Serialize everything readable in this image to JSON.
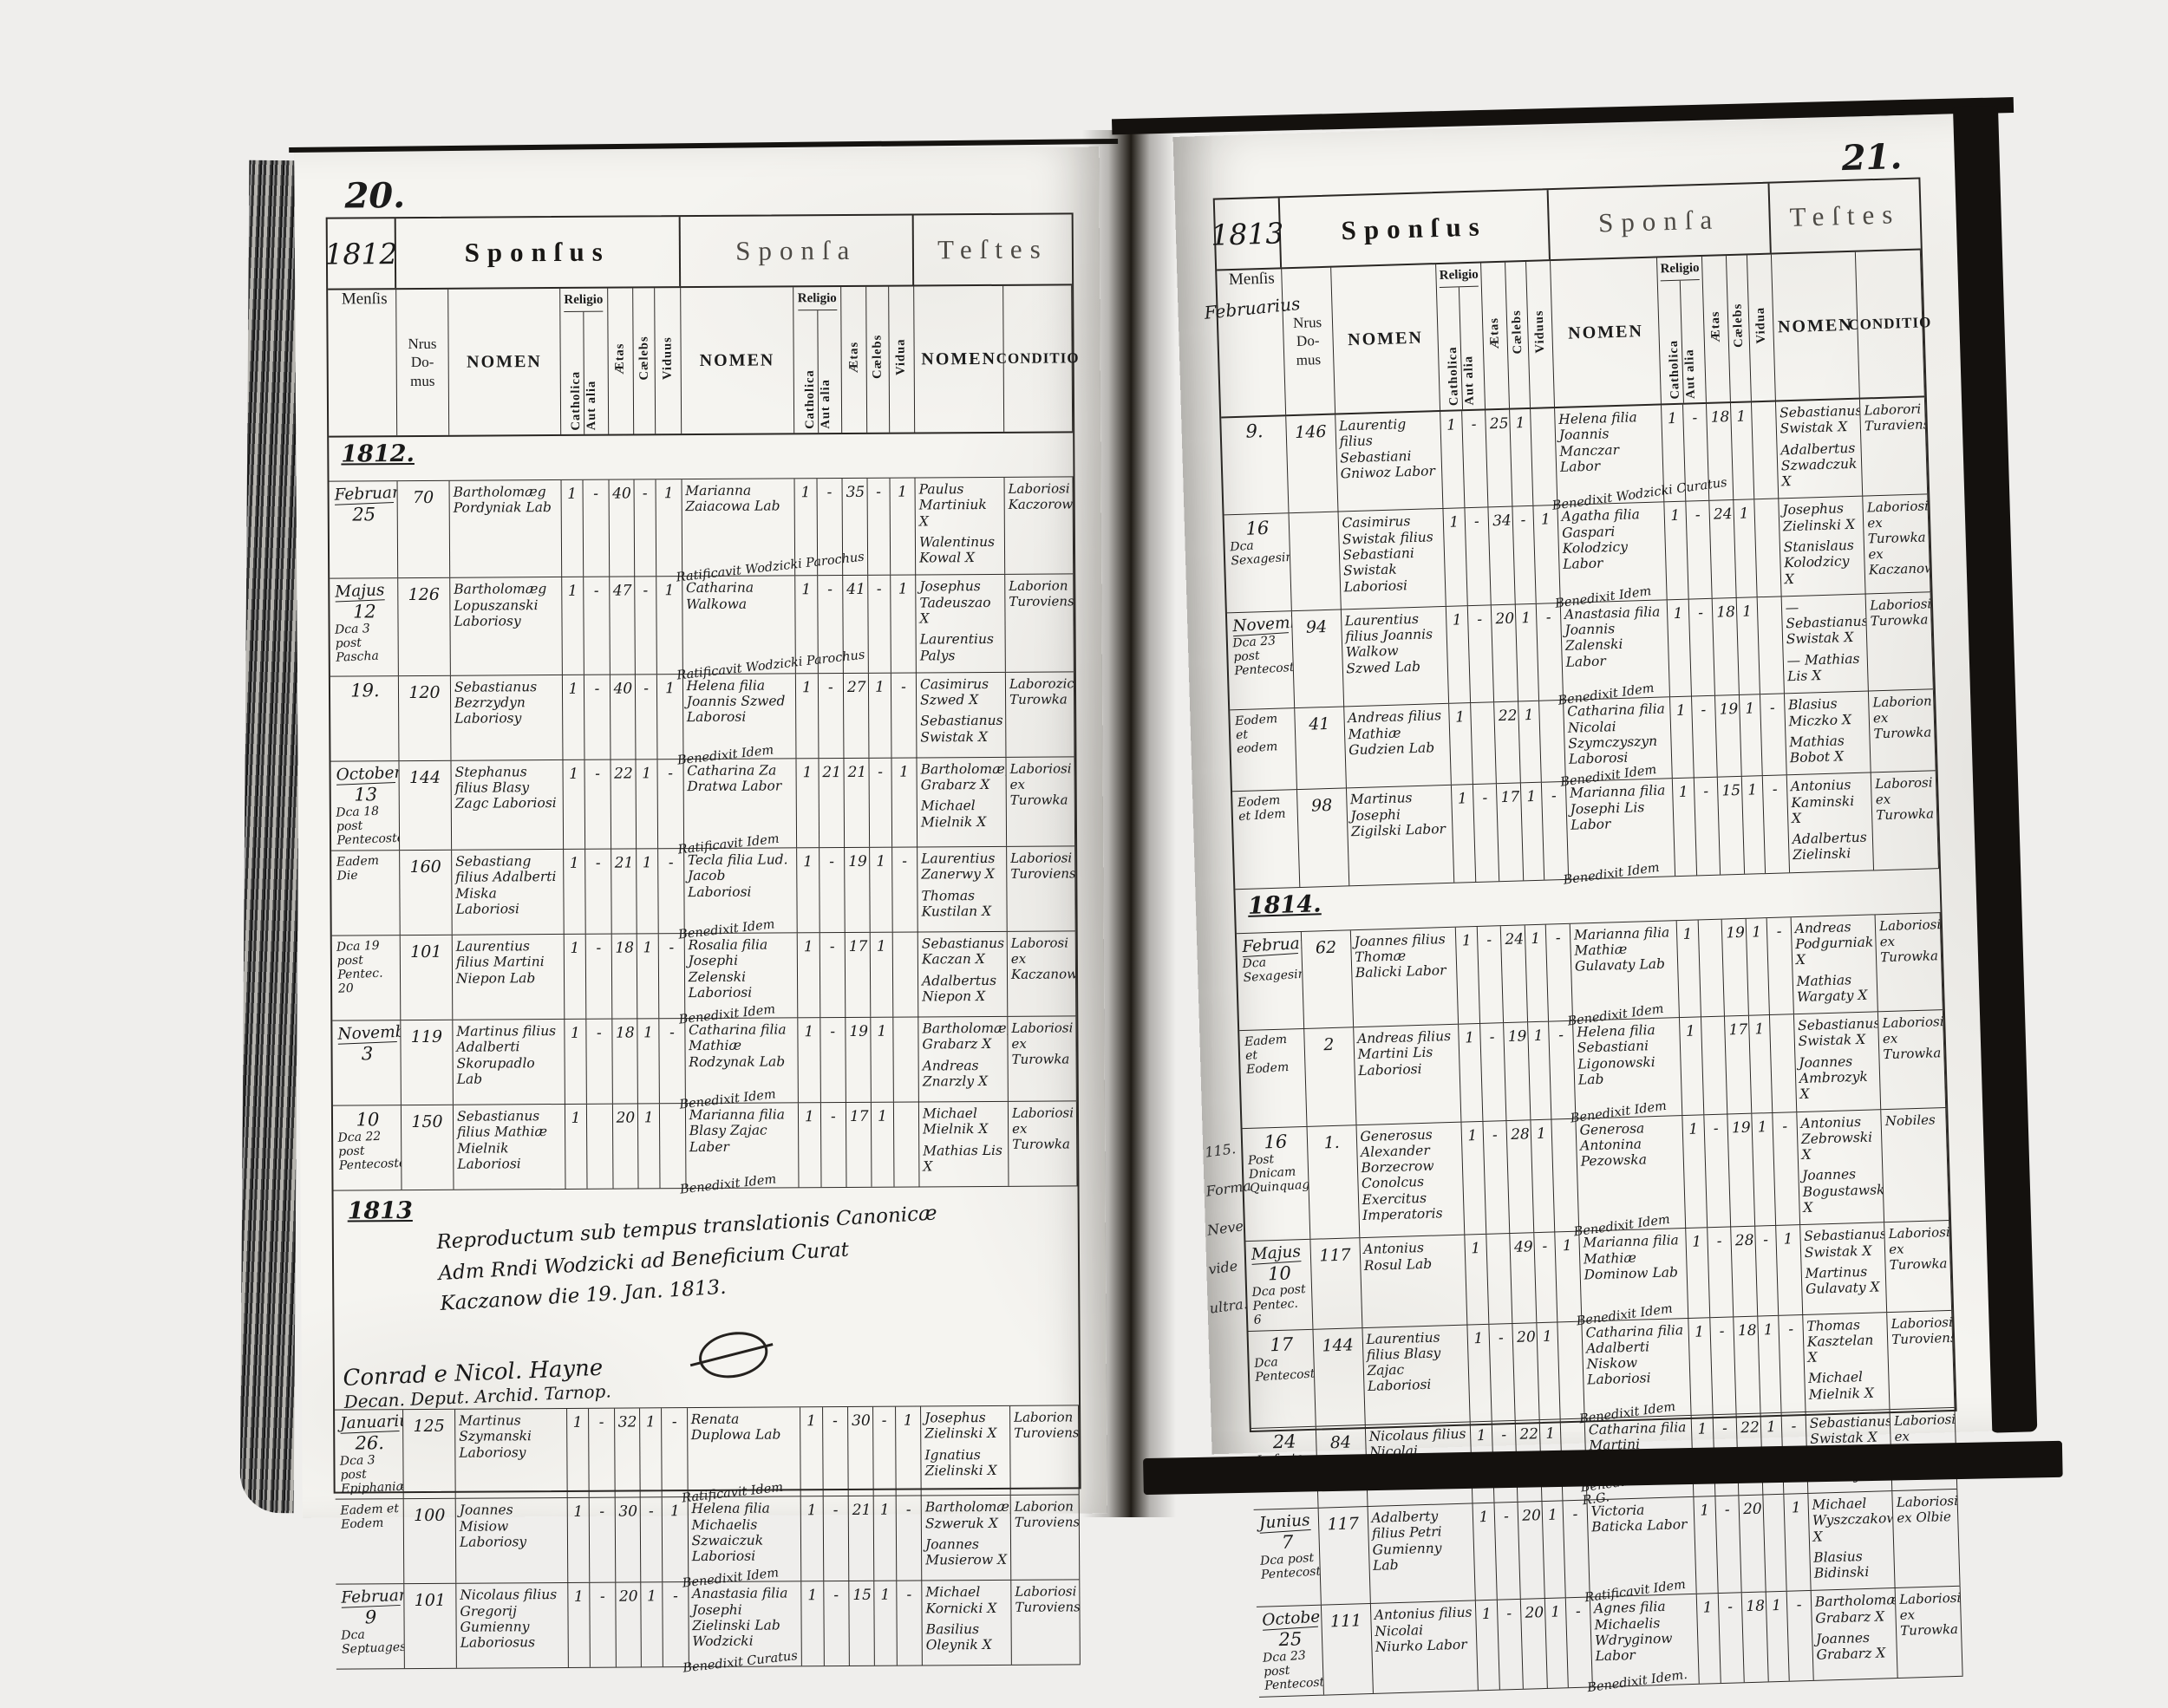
{
  "document": {
    "kind": "scanned parish marriage register, two-page spread"
  },
  "book": {
    "header_labels": {
      "sponsus": "Sponſus",
      "sponsa": "Sponſa",
      "testes": "Teſtes",
      "mensis": "Menſis",
      "nrus": "Nrus\nDo-\nmus",
      "nomen": "NOMEN",
      "religio": "Religio",
      "catholica": "Catholica",
      "aut_alia": "Aut alia",
      "aetas": "Ætas",
      "caelebs": "Cælebs",
      "viduus": "Viduus",
      "vidua": "Vidua",
      "conditio": "CONDITIO"
    },
    "left_page": {
      "page_number": "20.",
      "year_box": "1812",
      "rows": [
        {
          "type": "year",
          "label": "1812."
        },
        {
          "type": "entry",
          "month": "Februarius",
          "day": "25",
          "extra": "",
          "nrus": "70",
          "sponsus": "Bartholomæg Pordyniak Lab",
          "s": [
            "1",
            "-",
            "40",
            "-",
            "1"
          ],
          "sponsa": "Marianna Zaiacowa Lab",
          "ben": "Ratificavit Wodzicki Parochus",
          "sp": [
            "1",
            "-",
            "35",
            "-",
            "1"
          ],
          "testes": [
            "Paulus Martiniuk X",
            "Walentinus Kowal X"
          ],
          "conditio": "Laboriosi Kaczorowca"
        },
        {
          "type": "entry",
          "month": "Majus",
          "day": "12",
          "extra": "Dca 3 post Pascha",
          "nrus": "126",
          "sponsus": "Bartholomæg Lopuszanski Laboriosy",
          "s": [
            "1",
            "-",
            "47",
            "-",
            "1"
          ],
          "sponsa": "Catharina Walkowa",
          "ben": "Ratificavit Wodzicki Parochus",
          "sp": [
            "1",
            "-",
            "41",
            "-",
            "1"
          ],
          "testes": [
            "Josephus Tadeuszao X",
            "Laurentius Palys"
          ],
          "conditio": "Laborion Turoviensis"
        },
        {
          "type": "entry",
          "month": "",
          "day": "19.",
          "extra": "",
          "nrus": "120",
          "sponsus": "Sebastianus Bezrzydyn Laboriosy",
          "s": [
            "1",
            "-",
            "40",
            "-",
            "1"
          ],
          "sponsa": "Helena filia Joannis Szwed Laborosi",
          "ben": "Benedixit Idem",
          "sp": [
            "1",
            "-",
            "27",
            "1",
            "-"
          ],
          "testes": [
            "Casimirus Szwed X",
            "Sebastianus Swistak X"
          ],
          "conditio": "Laborozica Turowka"
        },
        {
          "type": "entry",
          "month": "October",
          "day": "13",
          "extra": "Dca 18 post Pentecosten",
          "nrus": "144",
          "sponsus": "Stephanus filius Blasy Zagc Laboriosi",
          "s": [
            "1",
            "-",
            "22",
            "1",
            "-"
          ],
          "sponsa": "Catharina Za Dratwa Labor",
          "ben": "Ratificavit Idem",
          "sp": [
            "1",
            "21",
            "21",
            "-",
            "1"
          ],
          "testes": [
            "Bartholomæg Grabarz X",
            "Michael Mielnik X"
          ],
          "conditio": "Laboriosi ex Turowka"
        },
        {
          "type": "entry",
          "month": "",
          "day": "",
          "extra": "Eadem Die",
          "nrus": "160",
          "sponsus": "Sebastiang filius Adalberti Miska Laboriosi",
          "s": [
            "1",
            "-",
            "21",
            "1",
            "-"
          ],
          "sponsa": "Tecla filia Lud. Jacob Laboriosi",
          "ben": "Benedixit Idem",
          "sp": [
            "1",
            "-",
            "19",
            "1",
            "-"
          ],
          "testes": [
            "Laurentius Zanerwy X",
            "Thomas Kustilan X"
          ],
          "conditio": "Laboriosi Turoviensis"
        },
        {
          "type": "entry",
          "month": "",
          "day": "",
          "extra": "Dca 19 post Pentec. 20",
          "nrus": "101",
          "sponsus": "Laurentius filius Martini Niepon Lab",
          "s": [
            "1",
            "-",
            "18",
            "1",
            "-"
          ],
          "sponsa": "Rosalia filia Josephi Zelenski Laboriosi",
          "ben": "Benedixit Idem",
          "sp": [
            "1",
            "-",
            "17",
            "1",
            ""
          ],
          "testes": [
            "Sebastianus Kaczan X",
            "Adalbertus Niepon X"
          ],
          "conditio": "Laborosi ex Kaczanowka"
        },
        {
          "type": "entry",
          "month": "November",
          "day": "3",
          "extra": "",
          "nrus": "119",
          "sponsus": "Martinus filius Adalberti Skorupadlo Lab",
          "s": [
            "1",
            "-",
            "18",
            "1",
            "-"
          ],
          "sponsa": "Catharina filia Mathiæ Rodzynak Lab",
          "ben": "Benedixit Idem",
          "sp": [
            "1",
            "-",
            "19",
            "1",
            ""
          ],
          "testes": [
            "Bartholomæg Grabarz X",
            "Andreas Znarzly X"
          ],
          "conditio": "Laboriosi ex Turowka"
        },
        {
          "type": "entry",
          "month": "",
          "day": "10",
          "extra": "Dca 22 post Pentecosten",
          "nrus": "150",
          "sponsus": "Sebastianus filius Mathiæ Mielnik Laboriosi",
          "s": [
            "1",
            "",
            "20",
            "1",
            ""
          ],
          "sponsa": "Marianna filia Blasy Zajac Laber",
          "ben": "Benedixit Idem",
          "sp": [
            "1",
            "-",
            "17",
            "1",
            ""
          ],
          "testes": [
            "Michael Mielnik X",
            "Mathias Lis X"
          ],
          "conditio": "Laboriosi ex Turowka"
        },
        {
          "type": "note",
          "year": "1813",
          "lines": [
            "Reproductum sub tempus translationis Canonicæ",
            "Adm Rndi Wodzicki ad Beneficium Curat",
            "Kaczanow        die 19. Jan. 1813."
          ],
          "signature": [
            "Conrad e Nicol. Hayne",
            "Decan. Deput. Archid. Tarnop."
          ]
        },
        {
          "type": "entry",
          "month": "Januarius",
          "day": "26.",
          "extra": "Dca 3 post Epiphaniæ",
          "nrus": "125",
          "sponsus": "Martinus Szymanski Laboriosy",
          "s": [
            "1",
            "-",
            "32",
            "1",
            "-"
          ],
          "sponsa": "Renata Duplowa Lab",
          "ben": "Ratificavit Idem",
          "sp": [
            "1",
            "-",
            "30",
            "-",
            "1"
          ],
          "testes": [
            "Josephus Zielinski X",
            "Ignatius Zielinski X"
          ],
          "conditio": "Laborion Turoviensis"
        },
        {
          "type": "entry",
          "month": "",
          "day": "",
          "extra": "Eadem et Eodem",
          "nrus": "100",
          "sponsus": "Joannes Misiow Laboriosy",
          "s": [
            "1",
            "-",
            "30",
            "-",
            "1"
          ],
          "sponsa": "Helena filia Michaelis Szwaiczuk Laboriosi",
          "ben": "Benedixit Idem",
          "sp": [
            "1",
            "-",
            "21",
            "1",
            "-"
          ],
          "testes": [
            "Bartholomæg Szweruk X",
            "Joannes Musierow X"
          ],
          "conditio": "Laborion Turoviensis"
        },
        {
          "type": "entry",
          "month": "Februarius",
          "day": "9",
          "extra": "Dca Septuagesima",
          "nrus": "101",
          "sponsus": "Nicolaus filius Gregorij Gumienny Laboriosus",
          "s": [
            "1",
            "-",
            "20",
            "1",
            "-"
          ],
          "sponsa": "Anastasia filia Josephi Zielinski Lab Wodzicki",
          "ben": "Benedixit Curatus",
          "sp": [
            "1",
            "-",
            "15",
            "1",
            "-"
          ],
          "testes": [
            "Michael Kornicki X",
            "Basilius Oleynik X"
          ],
          "conditio": "Laboriosi Turoviensis"
        }
      ]
    },
    "right_page": {
      "page_number": "21.",
      "year_box": "1813",
      "mensis_hw": "Februarius",
      "margin_notes": [
        "115.",
        "Forma",
        "Neve",
        "vide",
        "ultra."
      ],
      "rows": [
        {
          "type": "entry",
          "month": "",
          "day": "9.",
          "extra": "",
          "nrus": "146",
          "sponsus": "Laurentig filius Sebastiani Gniwoz Labor",
          "s": [
            "1",
            "-",
            "25",
            "1",
            ""
          ],
          "sponsa": "Helena filia Joannis Manczar Labor",
          "ben": "Benedixit Wodzicki Curatus",
          "sp": [
            "1",
            "-",
            "18",
            "1",
            ""
          ],
          "testes": [
            "Sebastianus Swistak X",
            "Adalbertus Szwadczuk X"
          ],
          "conditio": "Laborori Turaviensi"
        },
        {
          "type": "entry",
          "month": "",
          "day": "16",
          "extra": "Dca Sexagesima",
          "nrus": "",
          "sponsus": "Casimirus Swistak filius Sebastiani Swistak Laboriosi",
          "s": [
            "1",
            "-",
            "34",
            "-",
            "1"
          ],
          "sponsa": "Agatha filia Gaspari Kolodzicy Labor",
          "ben": "Benedixit Idem",
          "sp": [
            "1",
            "-",
            "24",
            "1",
            ""
          ],
          "testes": [
            "Josephus Zielinski X",
            "Stanislaus Kolodzicy X"
          ],
          "conditio": "Laboriosi ex Turowka ex Kaczanowka"
        },
        {
          "type": "entry",
          "month": "November",
          "day": "",
          "extra": "Dca 23 post Pentecosten",
          "nrus": "94",
          "sponsus": "Laurentius filius Joannis Walkow Szwed Lab",
          "s": [
            "1",
            "-",
            "20",
            "1",
            "-"
          ],
          "sponsa": "Anastasia filia Joannis Zalenski Labor",
          "ben": "Benedixit Idem",
          "sp": [
            "1",
            "-",
            "18",
            "1",
            ""
          ],
          "testes": [
            "— Sebastianus Swistak X",
            "— Mathias Lis X"
          ],
          "conditio": "Laboriosi Turowka"
        },
        {
          "type": "entry",
          "month": "",
          "day": "",
          "extra": "Eodem et eodem",
          "nrus": "41",
          "sponsus": "Andreas filius Mathiæ Gudzien Lab",
          "s": [
            "1",
            "",
            "22",
            "1",
            ""
          ],
          "sponsa": "Catharina filia Nicolai Szymczyszyn Laborosi",
          "ben": "Benedixit Idem",
          "sp": [
            "1",
            "-",
            "19",
            "1",
            "-"
          ],
          "testes": [
            "Blasius Miczko X",
            "Mathias Bobot X"
          ],
          "conditio": "Laborion ex Turowka"
        },
        {
          "type": "entry",
          "month": "",
          "day": "",
          "extra": "Eodem et Idem",
          "nrus": "98",
          "sponsus": "Martinus Josephi Zigilski Labor",
          "s": [
            "1",
            "-",
            "17",
            "1",
            "-"
          ],
          "sponsa": "Marianna filia Josephi Lis Labor",
          "ben": "Benedixit Idem",
          "sp": [
            "1",
            "-",
            "15",
            "1",
            "-"
          ],
          "testes": [
            "Antonius Kaminski X",
            "Adalbertus Zielinski"
          ],
          "conditio": "Laborosi ex Turowka"
        },
        {
          "type": "year",
          "label": "1814."
        },
        {
          "type": "entry",
          "month": "Februarius",
          "day": "",
          "extra": "Dca Sexagesima",
          "nrus": "62",
          "sponsus": "Joannes filius Thomæ Balicki Labor",
          "s": [
            "1",
            "-",
            "24",
            "1",
            "-"
          ],
          "sponsa": "Marianna filia Mathiæ Gulavaty Lab",
          "ben": "Benedixit Idem",
          "sp": [
            "1",
            "",
            "19",
            "1",
            "-"
          ],
          "testes": [
            "Andreas Podgurniak X",
            "Mathias Wargaty X"
          ],
          "conditio": "Laboriosi ex Turowka"
        },
        {
          "type": "entry",
          "month": "",
          "day": "",
          "extra": "Eadem et Eodem",
          "nrus": "2",
          "sponsus": "Andreas filius Martini Lis Laboriosi",
          "s": [
            "1",
            "-",
            "19",
            "1",
            "-"
          ],
          "sponsa": "Helena filia Sebastiani Ligonowski Lab",
          "ben": "Benedixit Idem",
          "sp": [
            "1",
            "",
            "17",
            "1",
            ""
          ],
          "testes": [
            "Sebastianus Swistak X",
            "Joannes Ambrozyk X"
          ],
          "conditio": "Laboriosi ex Turowka"
        },
        {
          "type": "entry",
          "month": "",
          "day": "16",
          "extra": "Post Dnicam Quinquagesima",
          "nrus": "1.",
          "sponsus": "Generosus Alexander Borzecrow Conolcus Exercitus Imperatoris",
          "s": [
            "1",
            "-",
            "28",
            "1",
            ""
          ],
          "sponsa": "Generosa Antonina Pezowska",
          "ben": "Benedixit Idem",
          "sp": [
            "1",
            "-",
            "19",
            "1",
            "-"
          ],
          "testes": [
            "Antonius Zebrowski X",
            "Joannes Bogustawski X"
          ],
          "conditio": "Nobiles"
        },
        {
          "type": "entry",
          "month": "Majus",
          "day": "10",
          "extra": "Dca post Pentec. 6",
          "nrus": "117",
          "sponsus": "Antonius Rosul Lab",
          "s": [
            "1",
            "",
            "49",
            "-",
            "1"
          ],
          "sponsa": "Marianna filia Mathiæ Dominow Lab",
          "ben": "Benedixit Idem",
          "sp": [
            "1",
            "-",
            "28",
            "-",
            "1"
          ],
          "testes": [
            "Sebastianus Swistak X",
            "Martinus Gulavaty X"
          ],
          "conditio": "Laboriosi ex Turowka"
        },
        {
          "type": "entry",
          "month": "",
          "day": "17",
          "extra": "Dca Pentecosten",
          "nrus": "144",
          "sponsus": "Laurentius filius Blasy Zajac Laboriosi",
          "s": [
            "1",
            "-",
            "20",
            "1",
            ""
          ],
          "sponsa": "Catharina filia Adalberti Niskow Laboriosi",
          "ben": "Benedixit Idem",
          "sp": [
            "1",
            "-",
            "18",
            "1",
            "-"
          ],
          "testes": [
            "Thomas Kasztelan X",
            "Michael Mielnik X"
          ],
          "conditio": "Laboriosi Turoviensis"
        },
        {
          "type": "entry",
          "month": "",
          "day": "24",
          "extra": "In festo SSmæ Trinitatis",
          "nrus": "84",
          "sponsus": "Nicolaus filius Nicolai Szymczyszyn Laboriosi",
          "s": [
            "1",
            "-",
            "22",
            "1",
            ""
          ],
          "sponsa": "Catharina filia Martini Gulowaty Labor",
          "ben": "Benedixit Sowczynski Parochy R.G.",
          "sp": [
            "1",
            "-",
            "22",
            "1",
            "-"
          ],
          "testes": [
            "Sebastianus Swistak X",
            "Gregorius Durnay X"
          ],
          "conditio": "Laboriosi ex Turowka"
        },
        {
          "type": "entry",
          "month": "Junius",
          "day": "7",
          "extra": "Dca post Pentecosten",
          "nrus": "117",
          "sponsus": "Adalberty filius Petri Gumienny Lab",
          "s": [
            "1",
            "-",
            "20",
            "1",
            "-"
          ],
          "sponsa": "Victoria Baticka Labor",
          "ben": "Ratificavit Idem",
          "sp": [
            "1",
            "-",
            "20",
            "",
            "1"
          ],
          "testes": [
            "Michael Wyszczakowski X",
            "Blasius Bidinski"
          ],
          "conditio": "Laboriosi ex Olbie"
        },
        {
          "type": "entry",
          "month": "October",
          "day": "25",
          "extra": "Dca 23 post Pentecosten",
          "nrus": "111",
          "sponsus": "Antonius filius Nicolai Niurko Labor",
          "s": [
            "1",
            "-",
            "20",
            "1",
            "-"
          ],
          "sponsa": "Agnes filia Michaelis Wdryginow Labor",
          "ben": "Benedixit Idem.",
          "sp": [
            "1",
            "-",
            "18",
            "1",
            "-"
          ],
          "testes": [
            "Bartholomæg Grabarz X",
            "Joannes Grabarz X"
          ],
          "conditio": "Laboriosi ex Turowka"
        }
      ]
    }
  }
}
